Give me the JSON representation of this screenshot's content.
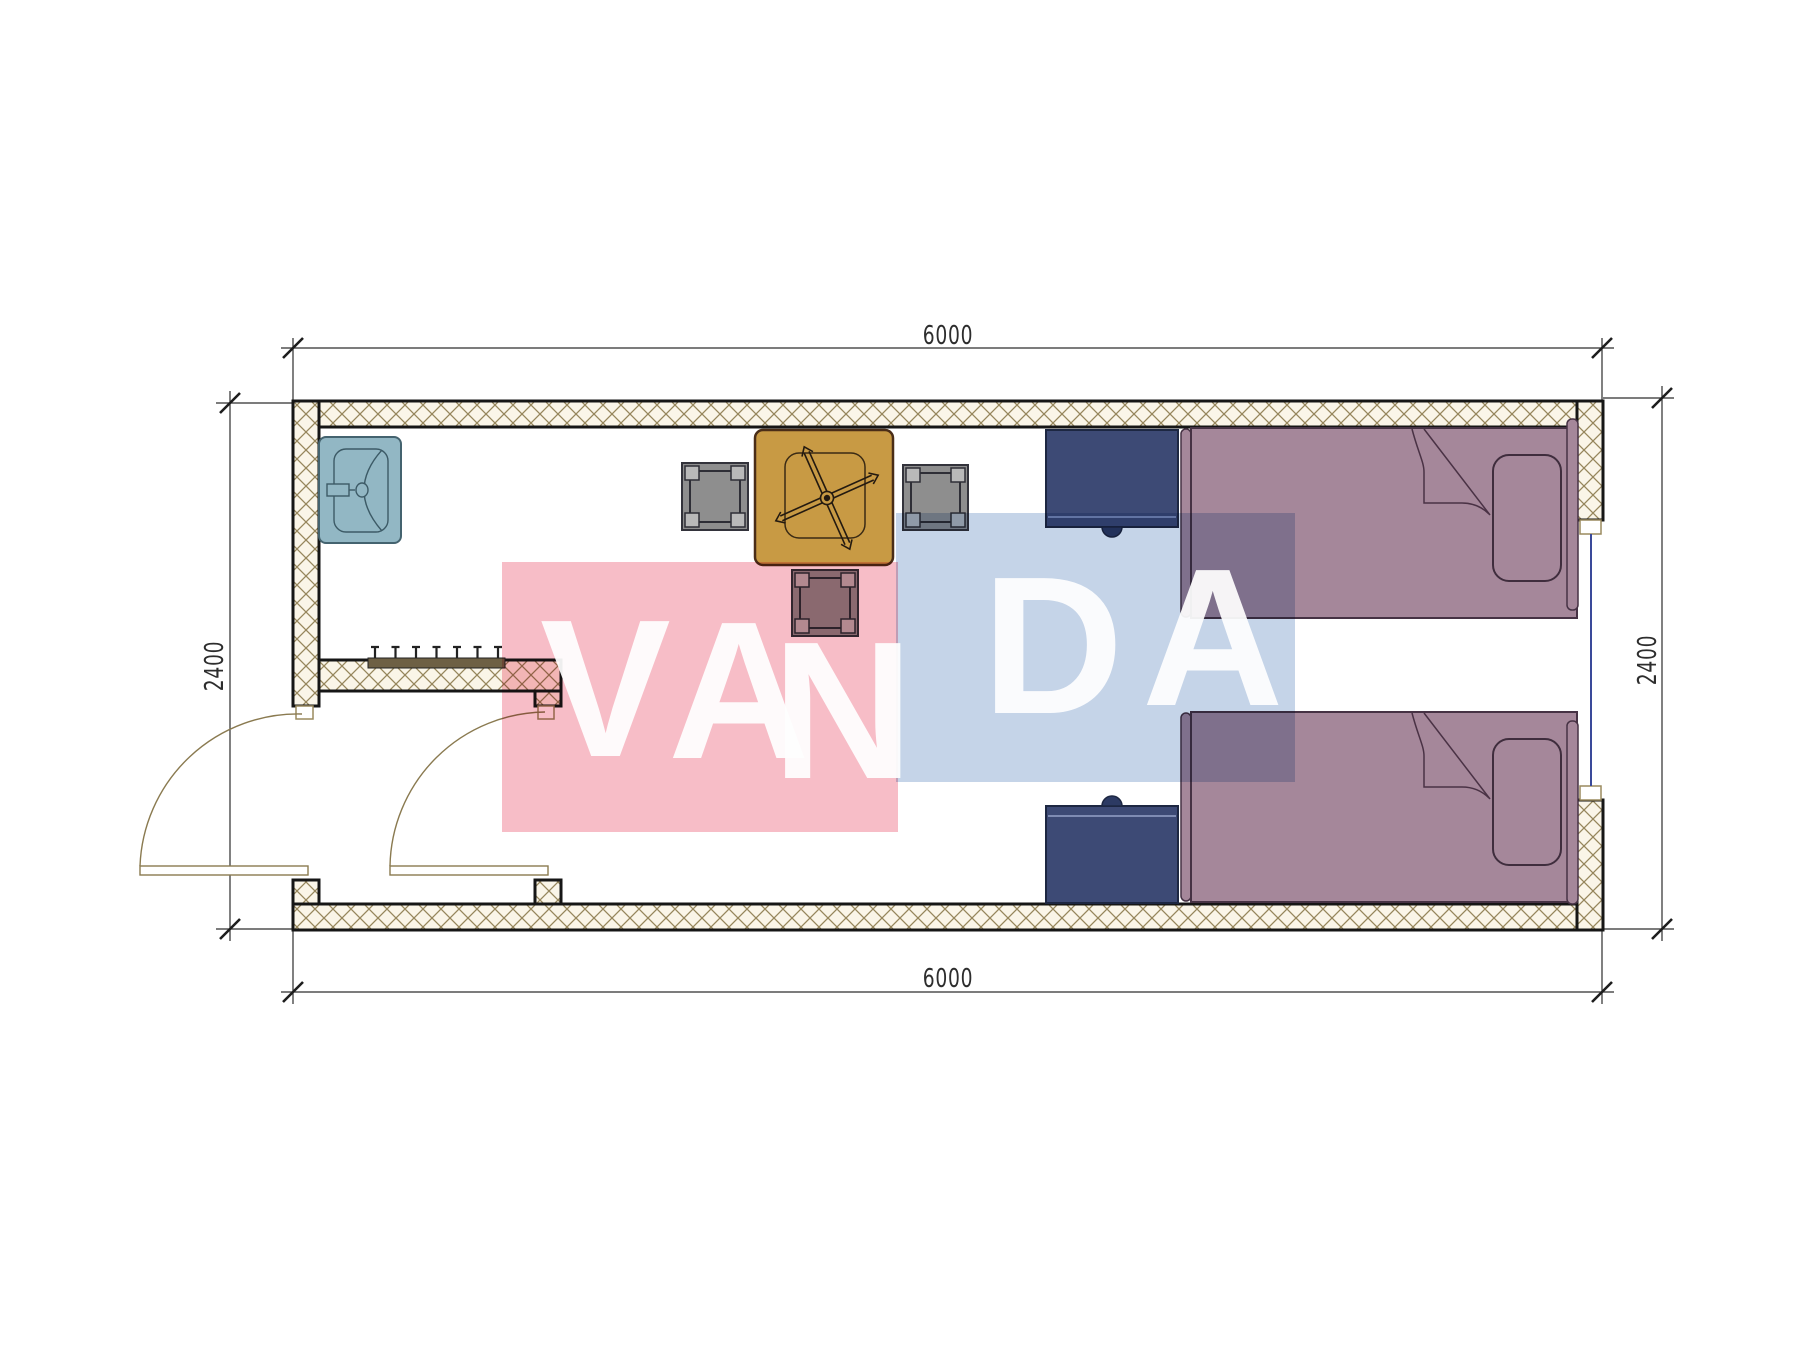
{
  "drawing": {
    "type": "architectural-floor-plan",
    "dimensions": {
      "top_mm": "6000",
      "bottom_mm": "6000",
      "left_mm": "2400",
      "right_mm": "2400"
    },
    "watermark": {
      "word": "VANDA",
      "letters": [
        "V",
        "A",
        "N",
        "D",
        "A"
      ],
      "pink_color": "#f7bdc7",
      "blue_color": "#c5d4e8",
      "text_color": "#ffffff"
    },
    "colors": {
      "wall_fill": "#faf5e8",
      "wall_hatch": "#96865c",
      "wall_outline": "#161616",
      "sink": "#92b7c4",
      "table": "#c89a44",
      "stool": "#8e8e8e",
      "stool_pad": "#b9b9b9",
      "nightstand": "#3d4a75",
      "bed": "#a5879a",
      "bed_outline": "#463244",
      "door_swing": "#8a7a50",
      "window_glass": "#3a4a9a",
      "coat_rack": "#6e6044",
      "dimension_line": "#2d2d2d"
    },
    "symbols": [
      "exterior-wall",
      "interior-partition",
      "entry-door",
      "vestibule-door",
      "window",
      "sink",
      "coat-hook-rack",
      "dining-table",
      "ceiling-fan-symbol",
      "stool",
      "nightstand",
      "single-bed",
      "pillow"
    ]
  }
}
